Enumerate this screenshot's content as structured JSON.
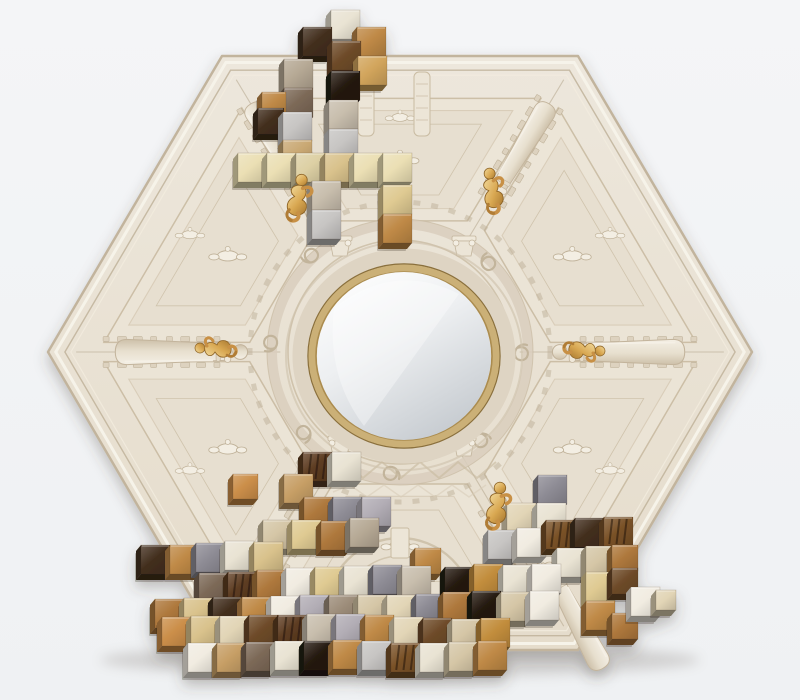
{
  "scene": {
    "description_colors": {
      "wall_top": "#f4f5f7",
      "wall_bottom": "#eff1f3",
      "shadow": "rgba(70,60,50,0.28)"
    },
    "hexagon": {
      "vertices": [
        [
          222,
          56
        ],
        [
          578,
          56
        ],
        [
          752,
          352
        ],
        [
          578,
          650
        ],
        [
          222,
          650
        ],
        [
          48,
          352
        ]
      ],
      "center": [
        400,
        352
      ],
      "fill_top": "#ede7dc",
      "fill_bottom": "#e5dccb",
      "edge_outer": "#c2b49d",
      "edge_highlight": "#f7f3ea",
      "edge_crease": "#bdaf96",
      "relief_line": "#c9bba2",
      "relief_line_soft": "#d9cdb9",
      "relief_fill": "#ece5d7",
      "relief_fill_deep": "#e7dfd0",
      "ornament_fill": "#f3eee3",
      "ornament_stroke": "#bfb198"
    },
    "mirror": {
      "cx": 404,
      "cy": 356,
      "rx": 87,
      "ry": 84,
      "glass_top": "#ffffff",
      "glass_mid": "#edeff1",
      "glass_bottom": "#c6cbd0",
      "gold_ring": "#cbb077",
      "gold_ring_dark": "#8a6f3c",
      "gold_ring_mid": "#ab8c4f",
      "molding": "#ded4c3",
      "molding_outer": "#cfc3ae"
    },
    "balusters": [
      {
        "vertex": 5,
        "t": 0.43,
        "scale": 1.05
      },
      {
        "vertex": 2,
        "t": 0.43,
        "scale": 1.05
      },
      {
        "vertex": 0,
        "t": 0.5,
        "scale": 0.92
      },
      {
        "vertex": 1,
        "t": 0.5,
        "scale": 0.92
      }
    ],
    "loose_baluster": {
      "x": 546,
      "y": 562,
      "rot": 62,
      "scale": 0.95
    },
    "capitals": [
      [
        340,
        252
      ],
      [
        464,
        252
      ],
      [
        340,
        452
      ],
      [
        464,
        452
      ]
    ],
    "figurines": {
      "gold_light": "#f3dc9e",
      "gold_mid": "#d9a852",
      "gold_dark": "#a87830",
      "items": [
        {
          "x": 298,
          "y": 197,
          "rot": 8,
          "scale": 1.15
        },
        {
          "x": 492,
          "y": 190,
          "rot": -12,
          "scale": 1.1
        },
        {
          "x": 215,
          "y": 349,
          "rot": -90,
          "scale": 1.0
        },
        {
          "x": 585,
          "y": 350,
          "rot": 90,
          "scale": 1.0
        },
        {
          "x": 497,
          "y": 505,
          "rot": 6,
          "scale": 1.15
        }
      ]
    },
    "palette": {
      "cream": {
        "hex": "#e9e3d3"
      },
      "pearl": {
        "hex": "#f1ece1"
      },
      "champagne": {
        "hex": "#e2d5b6"
      },
      "butter": {
        "hex": "#ebdfb4"
      },
      "butterDark": {
        "hex": "#ddd0a4"
      },
      "tanLight": {
        "hex": "#d9c28c"
      },
      "tanMarble": {
        "hex": "#c9a873"
      },
      "paleGold": {
        "hex": "#dfca92"
      },
      "beige": {
        "hex": "#d5c6a6"
      },
      "beigeWarm": {
        "hex": "#d8c49e"
      },
      "grayBeige": {
        "hex": "#c8bead"
      },
      "warmGray": {
        "hex": "#b6a995"
      },
      "sageGray": {
        "hex": "#b5b0a0"
      },
      "taupe": {
        "hex": "#9c8c79"
      },
      "taupeDark": {
        "hex": "#7c6957"
      },
      "silver": {
        "hex": "#c7c5c3"
      },
      "slate": {
        "hex": "#8e8c95"
      },
      "lilac": {
        "hex": "#b2adb5"
      },
      "tan": {
        "hex": "#c79f66"
      },
      "golden": {
        "hex": "#d2a55c"
      },
      "camel": {
        "hex": "#bf8946"
      },
      "caramel": {
        "hex": "#ae783c"
      },
      "orange": {
        "hex": "#cb8e49"
      },
      "goldMetal": {
        "hex": "#c28d3c"
      },
      "walnut": {
        "hex": "#6e4b29"
      },
      "walnutGrain": {
        "hex": "#5d3c21",
        "stripes": true
      },
      "zebrano": {
        "hex": "#7a5228",
        "stripes": true
      },
      "espresso": {
        "hex": "#432f1e"
      },
      "blackBrown": {
        "hex": "#251a11"
      }
    },
    "cube_size": 29,
    "clusters": [
      {
        "name": "top-left-cluster",
        "cubes": [
          [
            331,
            10,
            "cream"
          ],
          [
            303,
            27,
            "espresso"
          ],
          [
            357,
            27,
            "camel"
          ],
          [
            332,
            41,
            "walnut"
          ],
          [
            358,
            56,
            "golden"
          ],
          [
            284,
            59,
            "warmGray"
          ],
          [
            331,
            71,
            "blackBrown"
          ],
          [
            284,
            88,
            "taupeDark"
          ],
          [
            262,
            92,
            "camel",
            24
          ],
          [
            329,
            100,
            "grayBeige"
          ],
          [
            258,
            108,
            "espresso",
            26
          ],
          [
            283,
            112,
            "silver"
          ],
          [
            329,
            129,
            "silver"
          ],
          [
            283,
            140,
            "tanMarble"
          ],
          [
            238,
            153,
            "butter"
          ],
          [
            267,
            153,
            "butter"
          ],
          [
            296,
            153,
            "butterDark"
          ],
          [
            325,
            153,
            "tanLight"
          ],
          [
            354,
            153,
            "butter"
          ],
          [
            383,
            153,
            "butter"
          ],
          [
            312,
            181,
            "grayBeige"
          ],
          [
            383,
            185,
            "paleGold"
          ],
          [
            312,
            210,
            "silver"
          ],
          [
            383,
            214,
            "camel"
          ]
        ]
      },
      {
        "name": "bottom-cluster",
        "cubes": [
          [
            303,
            452,
            "walnutGrain"
          ],
          [
            332,
            452,
            "cream"
          ],
          [
            284,
            474,
            "tan"
          ],
          [
            233,
            474,
            "orange",
            25
          ],
          [
            304,
            497,
            "caramel"
          ],
          [
            333,
            497,
            "slate"
          ],
          [
            362,
            497,
            "lilac"
          ],
          [
            263,
            520,
            "beige"
          ],
          [
            292,
            520,
            "paleGold"
          ],
          [
            321,
            521,
            "caramel"
          ],
          [
            350,
            518,
            "warmGray"
          ],
          [
            415,
            548,
            "camel",
            26
          ],
          [
            141,
            545,
            "espresso"
          ],
          [
            170,
            545,
            "camel"
          ],
          [
            196,
            543,
            "slate"
          ],
          [
            225,
            541,
            "cream"
          ],
          [
            254,
            542,
            "tanLight"
          ],
          [
            538,
            475,
            "slate"
          ],
          [
            507,
            503,
            "champagne"
          ],
          [
            537,
            503,
            "cream"
          ],
          [
            488,
            530,
            "silver"
          ],
          [
            517,
            528,
            "pearl"
          ],
          [
            546,
            520,
            "zebrano"
          ],
          [
            575,
            518,
            "espresso"
          ],
          [
            604,
            517,
            "zebrano"
          ],
          [
            557,
            548,
            "cream"
          ],
          [
            586,
            546,
            "beige"
          ],
          [
            612,
            545,
            "caramel",
            26
          ],
          [
            199,
            573,
            "taupeDark"
          ],
          [
            228,
            572,
            "walnutGrain"
          ],
          [
            257,
            570,
            "caramel"
          ],
          [
            286,
            568,
            "pearl"
          ],
          [
            315,
            567,
            "paleGold"
          ],
          [
            344,
            566,
            "cream"
          ],
          [
            373,
            565,
            "slate"
          ],
          [
            402,
            566,
            "grayBeige"
          ],
          [
            445,
            567,
            "blackBrown"
          ],
          [
            474,
            564,
            "goldMetal"
          ],
          [
            503,
            565,
            "cream"
          ],
          [
            532,
            564,
            "pearl"
          ],
          [
            586,
            572,
            "paleGold"
          ],
          [
            612,
            568,
            "walnut",
            26
          ],
          [
            155,
            599,
            "caramel"
          ],
          [
            184,
            598,
            "tanLight"
          ],
          [
            213,
            597,
            "espresso"
          ],
          [
            242,
            597,
            "camel"
          ],
          [
            271,
            596,
            "pearl"
          ],
          [
            300,
            595,
            "lilac"
          ],
          [
            329,
            595,
            "taupe"
          ],
          [
            358,
            595,
            "beige"
          ],
          [
            387,
            595,
            "champagne"
          ],
          [
            416,
            594,
            "slate",
            24
          ],
          [
            443,
            592,
            "caramel"
          ],
          [
            472,
            591,
            "blackBrown"
          ],
          [
            501,
            592,
            "beige"
          ],
          [
            530,
            591,
            "pearl"
          ],
          [
            586,
            601,
            "camel"
          ],
          [
            612,
            613,
            "caramel",
            26
          ],
          [
            631,
            587,
            "pearl"
          ],
          [
            656,
            590,
            "champagne",
            20
          ],
          [
            162,
            617,
            "orange"
          ],
          [
            191,
            616,
            "tanLight"
          ],
          [
            220,
            616,
            "champagne"
          ],
          [
            249,
            615,
            "walnut"
          ],
          [
            278,
            615,
            "walnutGrain"
          ],
          [
            307,
            614,
            "grayBeige"
          ],
          [
            336,
            614,
            "lilac"
          ],
          [
            365,
            615,
            "camel"
          ],
          [
            394,
            617,
            "champagne"
          ],
          [
            423,
            618,
            "walnut"
          ],
          [
            452,
            619,
            "beige"
          ],
          [
            481,
            618,
            "goldMetal"
          ],
          [
            188,
            643,
            "pearl"
          ],
          [
            217,
            643,
            "tan"
          ],
          [
            246,
            642,
            "taupeDark"
          ],
          [
            275,
            641,
            "cream"
          ],
          [
            304,
            641,
            "blackBrown"
          ],
          [
            333,
            640,
            "camel"
          ],
          [
            362,
            641,
            "silver"
          ],
          [
            391,
            643,
            "zebrano"
          ],
          [
            420,
            643,
            "cream"
          ],
          [
            449,
            642,
            "beige"
          ],
          [
            478,
            641,
            "camel"
          ]
        ]
      }
    ]
  }
}
